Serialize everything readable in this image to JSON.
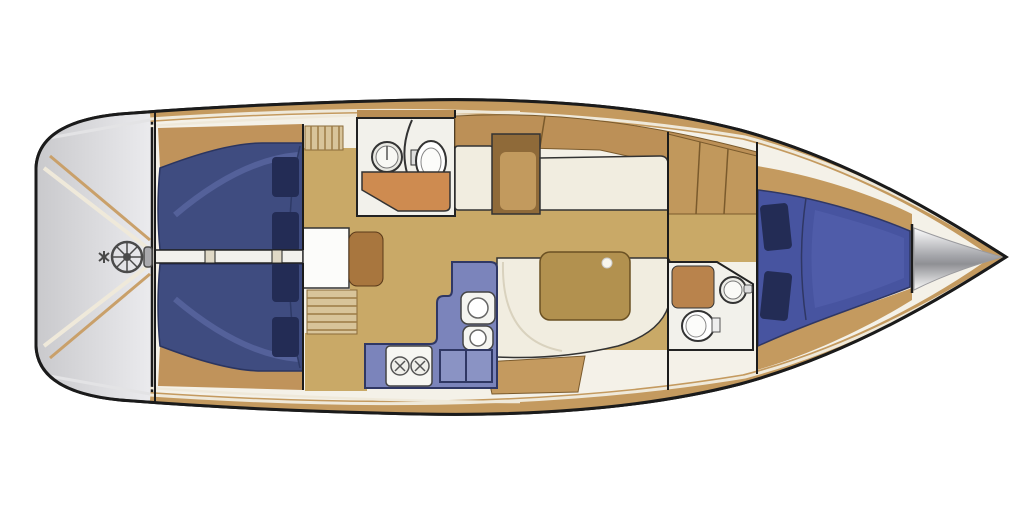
{
  "diagram": {
    "type": "yacht-interior-floorplan",
    "view": "top-down deck plan",
    "orientation": "bow-right-stern-left",
    "rooms": [
      "cockpit-with-steering-wheel",
      "aft-cabin-port-double-berth",
      "aft-cabin-starboard-double-berth",
      "companionway-steps",
      "aft-head-with-sink-and-toilet",
      "galley-with-double-sink-stove-and-fridge",
      "salon-with-table-and-settees",
      "forward-head-with-sink-and-toilet",
      "forward-v-berth-cabin",
      "anchor-locker-at-bow"
    ],
    "counts": {
      "berths": 3,
      "pillows_visible": 6,
      "toilets": 2,
      "sinks_bathroom": 2,
      "sinks_galley": 2,
      "stove_burners": 2
    }
  },
  "colors": {
    "background": "#ffffff",
    "hull_outline": "#1b1b1b",
    "hull_interior": "#f4f1e8",
    "deck_wood": "#c49a5f",
    "deck_stripe": "#efe9da",
    "transom_gray_light": "#e9e9eb",
    "transom_gray_dark": "#c6c6ca",
    "floor_wood": "#c9a967",
    "locker_wood": "#bc9057",
    "cabinet_wood_dark": "#a8763e",
    "cabinet_wood_mid": "#c29a5e",
    "berth_blue_aft": "#3f4c80",
    "berth_blue_fwd": "#4754a0",
    "berth_highlight": "#5a66a0",
    "pillow_navy": "#232c55",
    "galley_blue": "#7b84bb",
    "galley_lid_blue": "#8a93c4",
    "galley_outline": "#2f3764",
    "settee_cream": "#f1ede0",
    "table_wood": "#b2914f",
    "counter_orange": "#ce8b50",
    "fixture_white": "#f6f6f2",
    "room_white": "#f2f1eb",
    "walkway_white": "#f2f1ec",
    "steel_gray": "#4a4a4a"
  }
}
